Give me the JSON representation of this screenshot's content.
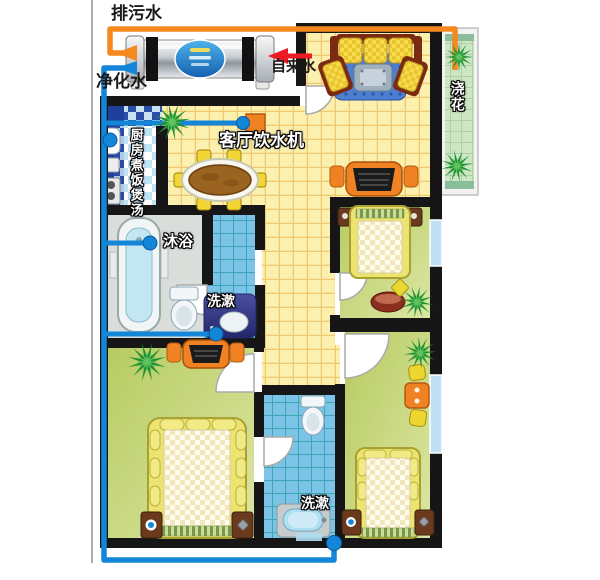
{
  "system_labels": {
    "drain": "排污水",
    "tap": "自来水",
    "purified": "净化水"
  },
  "usage_labels": {
    "dispenser": "客厅饮水机",
    "kitchen": "厨房煮饭煲汤",
    "shower": "沐浴",
    "wash_main_bath": "洗漱",
    "watering": "浇花",
    "wash_second_bath": "洗漱"
  },
  "palette": {
    "drain_pipe": "#F5881F",
    "purified_pipe": "#1486D8",
    "tap_water_arrow": "#ED1C24",
    "wall": "#161616",
    "living_floor": "#FBF0AE",
    "living_grid": "#E8A83C",
    "bedroom_floor": "#C5D372",
    "bathroom_tile": "#7CC3E8",
    "kitchen_counter": "#1E3F9A",
    "balcony_deck": "#CDE6C3",
    "accent_orange": "#F08223",
    "supply_dot": "#1486D8"
  }
}
